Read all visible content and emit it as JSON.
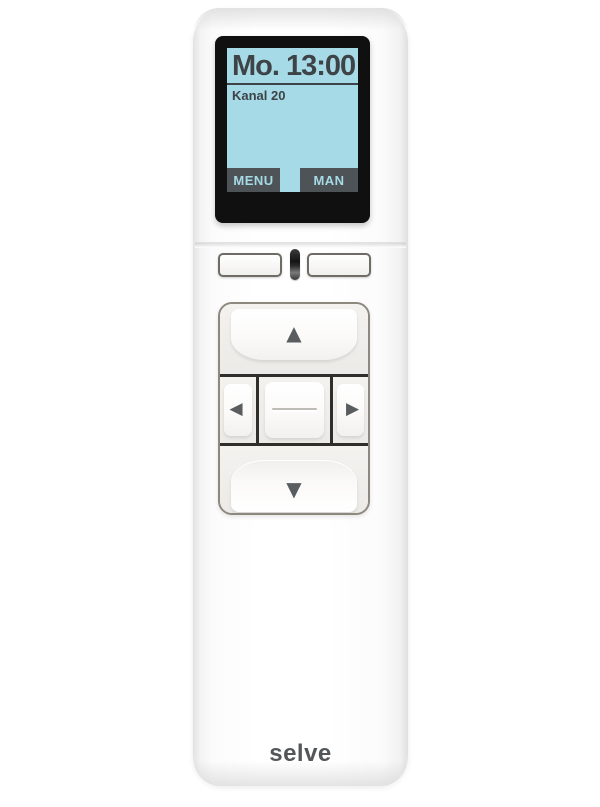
{
  "product": {
    "brand_logo": "selve"
  },
  "screen": {
    "title": "Mo. 13:00",
    "channel": "Kanal 20",
    "softkeys": {
      "left": "MENU",
      "right": "MAN"
    },
    "colors": {
      "display_bg": "#a6dae6",
      "display_fg": "#3d4347",
      "softkey_bg": "#4e5357",
      "frame": "#101010"
    }
  },
  "controls": {
    "icons": {
      "up": "▲",
      "down": "▼",
      "left": "◀",
      "right": "▶"
    }
  },
  "body_color": "#ffffff"
}
